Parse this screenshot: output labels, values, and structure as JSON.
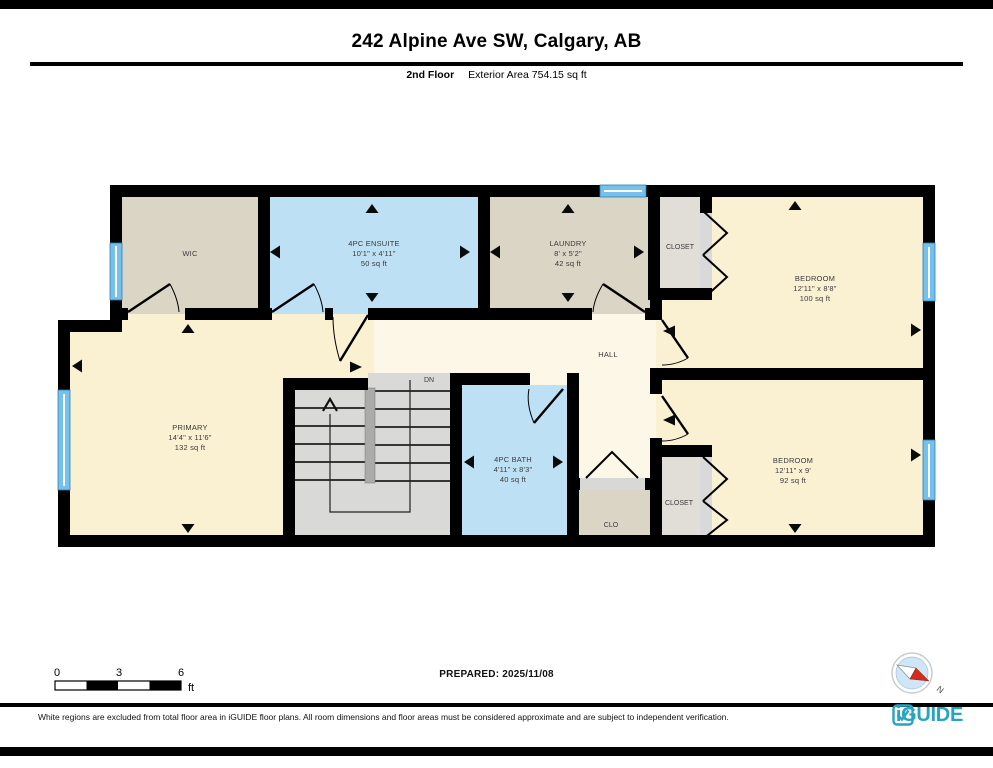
{
  "header": {
    "title": "242 Alpine Ave SW, Calgary, AB",
    "floor_label": "2nd Floor",
    "area_label": "Exterior Area 754.15 sq ft"
  },
  "rooms": {
    "wic": {
      "name": "WIC"
    },
    "ensuite": {
      "name": "4PC ENSUITE",
      "dims": "10'1\" x 4'11\"",
      "area": "50 sq ft"
    },
    "laundry": {
      "name": "LAUNDRY",
      "dims": "8' x 5'2\"",
      "area": "42 sq ft"
    },
    "closet_top": {
      "name": "CLOSET"
    },
    "bedroom_top": {
      "name": "BEDROOM",
      "dims": "12'11\" x 8'8\"",
      "area": "100 sq ft"
    },
    "hall": {
      "name": "HALL"
    },
    "primary": {
      "name": "PRIMARY",
      "dims": "14'4\" x 11'6\"",
      "area": "132 sq ft"
    },
    "stairs": {
      "label": "DN"
    },
    "bath": {
      "name": "4PC BATH",
      "dims": "4'11\" x 8'3\"",
      "area": "40 sq ft"
    },
    "clo": {
      "name": "CLO"
    },
    "closet_bottom": {
      "name": "CLOSET"
    },
    "bedroom_bottom": {
      "name": "BEDROOM",
      "dims": "12'11\" x 9'",
      "area": "92 sq ft"
    }
  },
  "scale_bar": {
    "tick0": "0",
    "tick1": "3",
    "tick2": "6",
    "unit": "ft"
  },
  "compass": {
    "label": "N"
  },
  "footer": {
    "prepared": "PREPARED: 2025/11/08",
    "disclaimer": "White regions are excluded from total floor area in iGUIDE floor plans. All room dimensions and floor areas must be considered approximate and are subject to independent verification.",
    "brand": "iGUIDE"
  },
  "colors": {
    "wall": "#000000",
    "room_cream": "#faf0d2",
    "hall_cream": "#fcf7e6",
    "room_beige": "#dbd5c6",
    "room_blue": "#bee0f4",
    "closet_gray": "#e1ded7",
    "stairs_gray": "#d9d9d7",
    "window_blue": "#76c1ec",
    "brand_teal": "#27a5bf",
    "compass_red": "#d32b1e"
  }
}
